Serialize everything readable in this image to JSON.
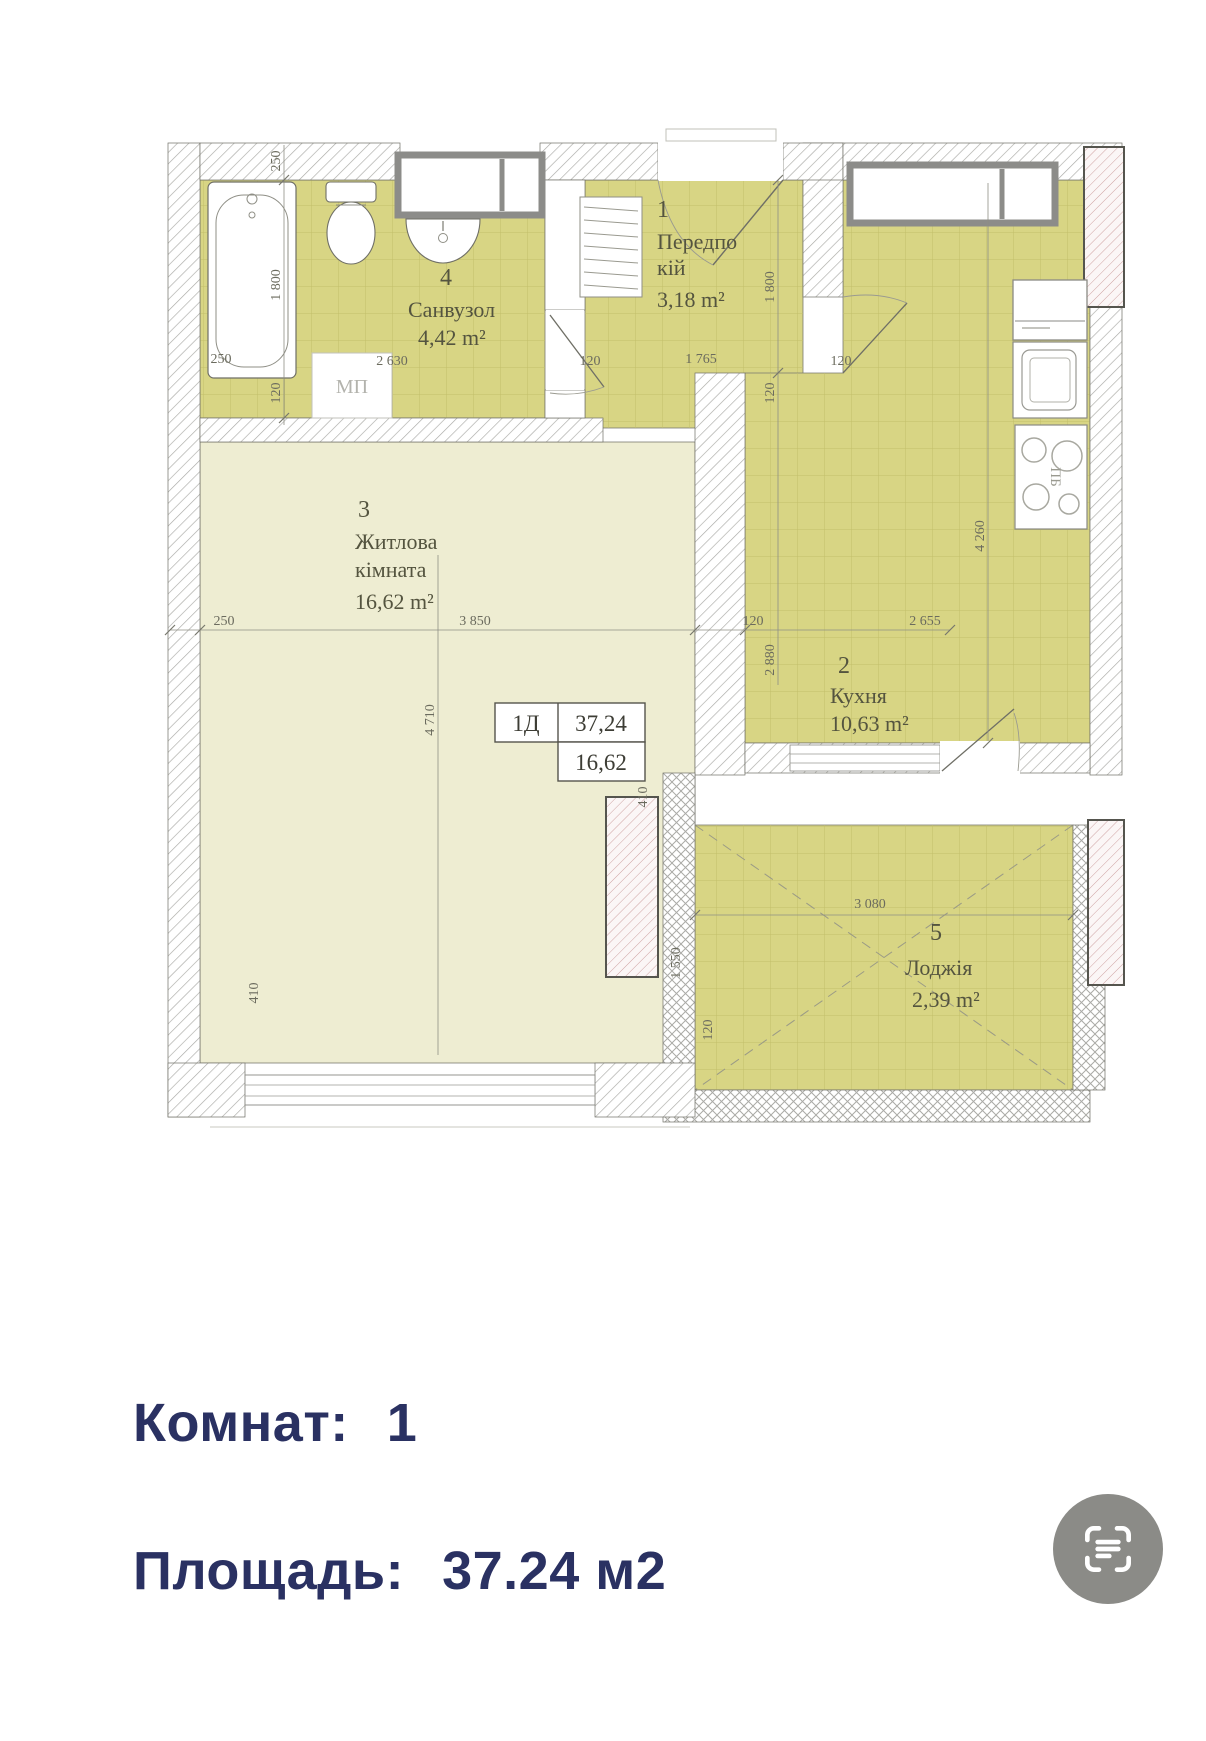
{
  "plan": {
    "tag": {
      "code": "1Д",
      "total_area": "37,24",
      "living_area": "16,62"
    },
    "rooms": {
      "hallway": {
        "number": "1",
        "name_line1": "Передпо",
        "name_line2": "кій",
        "area": "3,18 m²"
      },
      "kitchen": {
        "number": "2",
        "name": "Кухня",
        "area": "10,63 m²"
      },
      "living": {
        "number": "3",
        "name_line1": "Житлова",
        "name_line2": "кімната",
        "area": "16,62 m²"
      },
      "bathroom": {
        "number": "4",
        "name": "Санвузол",
        "area": "4,42 m²"
      },
      "loggia": {
        "number": "5",
        "name": "Лоджія",
        "area": "2,39 m²"
      }
    },
    "fixtures": {
      "washing_machine": "МП",
      "stove": "ПБ"
    },
    "dims": {
      "wall_top": "250",
      "bath_len": "1 800",
      "bath_wall": "250",
      "bath_width": "2 630",
      "bath_wall2": "120",
      "hall_wall_l": "120",
      "hall_width": "1 765",
      "hall_wall_r": "120",
      "hall_len": "1 800",
      "hall_wall_b": "120",
      "kit_wall": "120",
      "kit_width": "2 655",
      "kit_len1": "2 880",
      "kit_len2": "4 260",
      "liv_wall": "250",
      "liv_width": "3 850",
      "liv_len": "4 710",
      "liv_win": "410",
      "log_wall": "410",
      "log_width": "3 080",
      "log_len": "1 550",
      "log_wall_b": "120"
    }
  },
  "summary": {
    "rooms_label": "Комнат:",
    "rooms_value": "1",
    "area_label": "Площадь:",
    "area_value": "37.24 м2"
  },
  "colors": {
    "accent_text": "#2a3162",
    "icon_bg": "#8b8b87",
    "tile": "#d8d584",
    "tile_line": "#c2bf6a",
    "living_fill": "#eeedd2",
    "hatch": "#aaaaa6",
    "frame_grey": "#8c8c89",
    "plan_text": "#54543f",
    "dim_text": "#6b6b5e"
  }
}
